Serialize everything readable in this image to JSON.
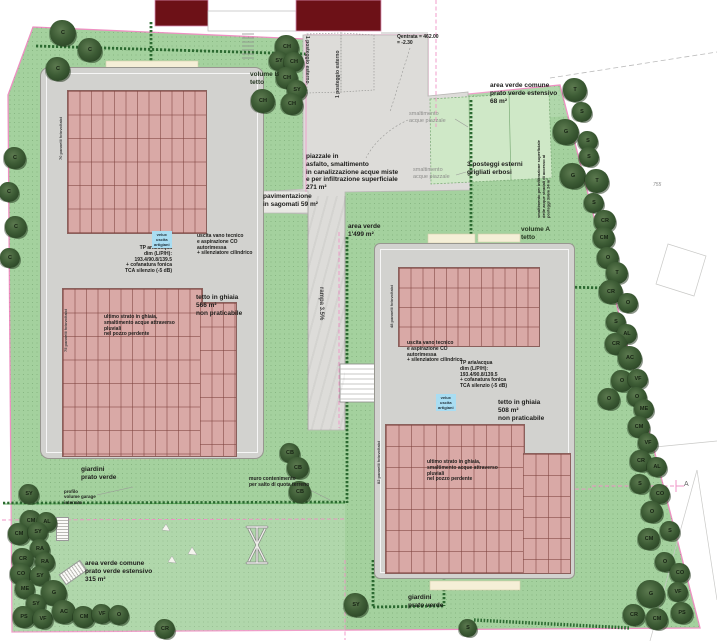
{
  "title": "piano del sito - volume A e volume B",
  "colors": {
    "boundary_pink": "#ee90c2",
    "green": "#a4d19e",
    "building_red": "#6d1117",
    "panel_pink": "#d9a9a6",
    "pad_gray": "#d2d2cf",
    "velux_blue": "#a9ddf2",
    "hedge_green": "#2c6a31"
  },
  "labels": {
    "posteggio_esterno": "1 posteggio esterno",
    "q_entrata": "Qentrata = 462.00\n= -2.30",
    "volume_b": "volume B\ntetto",
    "volume_a": "volume A\ntetto",
    "area_verde_comune_68": "area verde comune\nprato verde estensivo\n68 m²",
    "smaltimento_acque": "smaltimento\nacque piazzale",
    "piazzale": "piazzale in\nasfalto, smaltimento\nin canalizzazione acque miste\ne per infiltrazione superficiale\n271 m²",
    "pavimentazione": "pavimentazione\nin sagomati 59 m²",
    "area_verde_1499": "area verde\n1'499 m²",
    "posteggi_3": "3 posteggi esterni\ngrigliati erbosi",
    "infiltrazione_vert": "smaltimento per infiltrazione superficiale\ndelle acque stradali di accesso ai\nposteggi 3x6m   24 m²",
    "rampa": "rampa 3.5%",
    "pannelli_70": "70 pannelli fotovoltaici",
    "pannelli_75": "75 pannelli fotovoltaici",
    "pannelli_48": "48 pannelli fotovoltaici",
    "pannelli_82": "82 pannelli fotovoltaici",
    "velux": "velux\nuscita\nartigiani",
    "tp": "TP aria/acqua\ndim (L/P/H):\n193.4/90.8/139.5\n+ cofanatura fonica\nTCA silenzio (-5 dB)",
    "uscita_vano": "uscita vano tecnico\ne aspirazione CO\nautorimessa\n+ silenziatore cilindrico",
    "tetto_566": "tetto in ghiaia\n566 m²\nnon praticabile",
    "tetto_508": "tetto in ghiaia\n508 m²\nnon praticabile",
    "ultimo_strato": "ultimo strato in ghiaia,\nsmaltimento acque attraverso\npluviali\nnel pozzo perdente",
    "giardini": "giardini\nprato verde",
    "profilo": "profilo\nvolume garage\ninterrato",
    "muro": "muro contenimento\nper salto di quota terreno",
    "area_315": "area verde comune\nprato verde estensivo\n315 m²",
    "quota_755": "755",
    "section_a": "A"
  },
  "trees": [
    {
      "l": "C",
      "x": 63,
      "y": 33,
      "r": 13
    },
    {
      "l": "C",
      "x": 90,
      "y": 50,
      "r": 12
    },
    {
      "l": "C",
      "x": 58,
      "y": 69,
      "r": 12
    },
    {
      "l": "C",
      "x": 15,
      "y": 158,
      "r": 11
    },
    {
      "l": "C",
      "x": 9,
      "y": 192,
      "r": 10
    },
    {
      "l": "C",
      "x": 16,
      "y": 227,
      "r": 11
    },
    {
      "l": "C",
      "x": 10,
      "y": 258,
      "r": 10
    },
    {
      "l": "CH",
      "x": 287,
      "y": 47,
      "r": 12
    },
    {
      "l": "SY",
      "x": 279,
      "y": 61,
      "r": 10
    },
    {
      "l": "CH",
      "x": 294,
      "y": 62,
      "r": 10
    },
    {
      "l": "CH",
      "x": 287,
      "y": 78,
      "r": 11
    },
    {
      "l": "SY",
      "x": 297,
      "y": 90,
      "r": 10
    },
    {
      "l": "CH",
      "x": 263,
      "y": 101,
      "r": 12
    },
    {
      "l": "CH",
      "x": 292,
      "y": 104,
      "r": 11
    },
    {
      "l": "T",
      "x": 575,
      "y": 90,
      "r": 12
    },
    {
      "l": "S",
      "x": 582,
      "y": 112,
      "r": 10
    },
    {
      "l": "G",
      "x": 566,
      "y": 132,
      "r": 13
    },
    {
      "l": "S",
      "x": 588,
      "y": 141,
      "r": 10
    },
    {
      "l": "S",
      "x": 589,
      "y": 157,
      "r": 10
    },
    {
      "l": "G",
      "x": 573,
      "y": 176,
      "r": 13
    },
    {
      "l": "T",
      "x": 597,
      "y": 181,
      "r": 12
    },
    {
      "l": "S",
      "x": 594,
      "y": 203,
      "r": 10
    },
    {
      "l": "CR",
      "x": 605,
      "y": 221,
      "r": 11
    },
    {
      "l": "CM",
      "x": 604,
      "y": 238,
      "r": 11
    },
    {
      "l": "O",
      "x": 608,
      "y": 258,
      "r": 11
    },
    {
      "l": "T",
      "x": 617,
      "y": 273,
      "r": 11
    },
    {
      "l": "CR",
      "x": 611,
      "y": 292,
      "r": 12
    },
    {
      "l": "O",
      "x": 628,
      "y": 303,
      "r": 10
    },
    {
      "l": "S",
      "x": 616,
      "y": 322,
      "r": 10
    },
    {
      "l": "AL",
      "x": 627,
      "y": 334,
      "r": 10
    },
    {
      "l": "CR",
      "x": 616,
      "y": 344,
      "r": 11
    },
    {
      "l": "AC",
      "x": 630,
      "y": 358,
      "r": 12
    },
    {
      "l": "O",
      "x": 622,
      "y": 381,
      "r": 11
    },
    {
      "l": "VF",
      "x": 638,
      "y": 379,
      "r": 10
    },
    {
      "l": "O",
      "x": 609,
      "y": 399,
      "r": 11
    },
    {
      "l": "O",
      "x": 637,
      "y": 397,
      "r": 10
    },
    {
      "l": "ME",
      "x": 644,
      "y": 409,
      "r": 10
    },
    {
      "l": "CM",
      "x": 639,
      "y": 427,
      "r": 11
    },
    {
      "l": "VF",
      "x": 648,
      "y": 443,
      "r": 10
    },
    {
      "l": "CR",
      "x": 641,
      "y": 461,
      "r": 11
    },
    {
      "l": "AL",
      "x": 657,
      "y": 467,
      "r": 10
    },
    {
      "l": "S",
      "x": 640,
      "y": 484,
      "r": 10
    },
    {
      "l": "CO",
      "x": 660,
      "y": 494,
      "r": 10
    },
    {
      "l": "O",
      "x": 652,
      "y": 512,
      "r": 11
    },
    {
      "l": "S",
      "x": 670,
      "y": 531,
      "r": 10
    },
    {
      "l": "CM",
      "x": 649,
      "y": 539,
      "r": 11
    },
    {
      "l": "G",
      "x": 651,
      "y": 594,
      "r": 14
    },
    {
      "l": "O",
      "x": 665,
      "y": 562,
      "r": 10
    },
    {
      "l": "CO",
      "x": 680,
      "y": 573,
      "r": 10
    },
    {
      "l": "VF",
      "x": 678,
      "y": 592,
      "r": 10
    },
    {
      "l": "CR",
      "x": 634,
      "y": 615,
      "r": 11
    },
    {
      "l": "CM",
      "x": 657,
      "y": 619,
      "r": 11
    },
    {
      "l": "PS",
      "x": 682,
      "y": 613,
      "r": 11
    },
    {
      "l": "SY",
      "x": 356,
      "y": 605,
      "r": 12
    },
    {
      "l": "CB",
      "x": 290,
      "y": 453,
      "r": 10
    },
    {
      "l": "CB",
      "x": 298,
      "y": 468,
      "r": 11
    },
    {
      "l": "CB",
      "x": 300,
      "y": 492,
      "r": 11
    },
    {
      "l": "SY",
      "x": 29,
      "y": 494,
      "r": 10
    },
    {
      "l": "CM",
      "x": 31,
      "y": 521,
      "r": 11
    },
    {
      "l": "AL",
      "x": 47,
      "y": 522,
      "r": 10
    },
    {
      "l": "CM",
      "x": 19,
      "y": 534,
      "r": 11
    },
    {
      "l": "SY",
      "x": 38,
      "y": 532,
      "r": 10
    },
    {
      "l": "RA",
      "x": 40,
      "y": 549,
      "r": 10
    },
    {
      "l": "CR",
      "x": 23,
      "y": 559,
      "r": 11
    },
    {
      "l": "RA",
      "x": 45,
      "y": 562,
      "r": 10
    },
    {
      "l": "CO",
      "x": 21,
      "y": 574,
      "r": 11
    },
    {
      "l": "SY",
      "x": 40,
      "y": 576,
      "r": 10
    },
    {
      "l": "ME",
      "x": 25,
      "y": 589,
      "r": 10
    },
    {
      "l": "G",
      "x": 54,
      "y": 593,
      "r": 13
    },
    {
      "l": "SY",
      "x": 36,
      "y": 604,
      "r": 10
    },
    {
      "l": "PS",
      "x": 24,
      "y": 617,
      "r": 11
    },
    {
      "l": "VF",
      "x": 43,
      "y": 619,
      "r": 10
    },
    {
      "l": "AC",
      "x": 64,
      "y": 612,
      "r": 12
    },
    {
      "l": "CM",
      "x": 84,
      "y": 617,
      "r": 11
    },
    {
      "l": "VF",
      "x": 102,
      "y": 614,
      "r": 10
    },
    {
      "l": "O",
      "x": 119,
      "y": 615,
      "r": 10
    },
    {
      "l": "CR",
      "x": 165,
      "y": 629,
      "r": 10
    },
    {
      "l": "S",
      "x": 468,
      "y": 628,
      "r": 9
    }
  ]
}
